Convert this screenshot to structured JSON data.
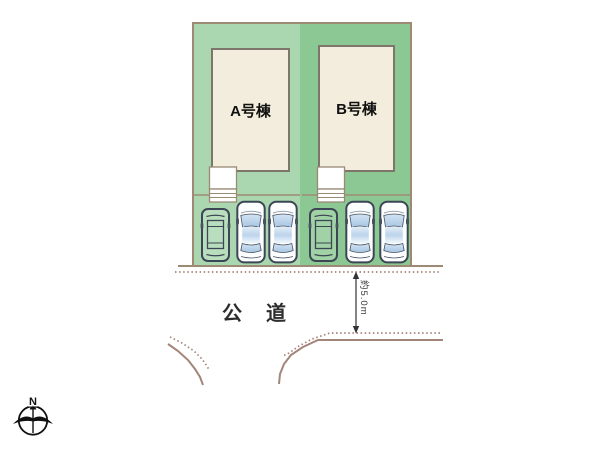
{
  "site_plan": {
    "lots": [
      {
        "id": "A",
        "building_label": "A号棟",
        "fill_color": "#aad7b0",
        "parking": {
          "car_icons": [
            "wagon-outline",
            "sedan",
            "sedan"
          ]
        }
      },
      {
        "id": "B",
        "building_label": "B号棟",
        "fill_color": "#8cc893",
        "parking": {
          "car_icons": [
            "wagon-outline",
            "sedan",
            "sedan"
          ]
        }
      }
    ],
    "road": {
      "label": "公　道",
      "width_dimension": "約5.0m"
    },
    "compass": {
      "north_label": "N"
    },
    "colors": {
      "lot_a_green": "#aad7b0",
      "lot_b_green": "#8cc893",
      "boundary_tan": "#9e8a74",
      "road_line_brown": "#a4857a",
      "building_cream": "#f2eddc",
      "building_border": "#7e766a",
      "car_outline": "#3d4654",
      "car_glass_blue": "#b0cce8",
      "text_dark": "#2d2d2d"
    }
  }
}
